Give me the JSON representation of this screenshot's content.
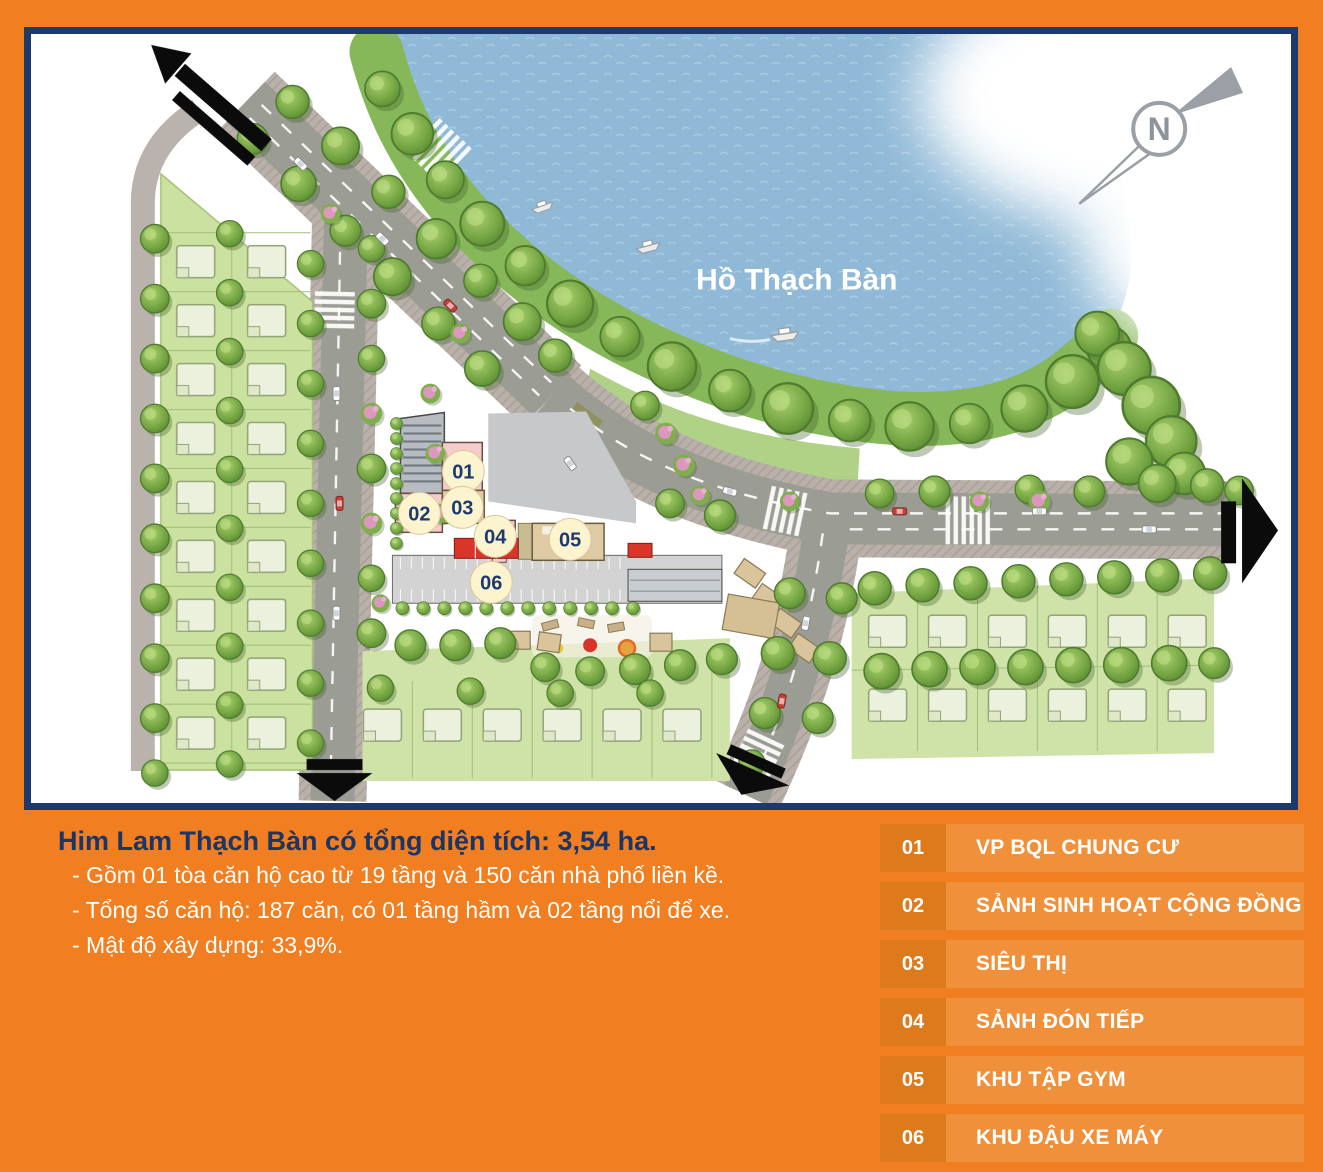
{
  "map": {
    "lake_label": "Hồ Thạch Bàn",
    "compass_label": "N",
    "markers": [
      "01",
      "02",
      "03",
      "04",
      "05",
      "06"
    ]
  },
  "info": {
    "title": "Him Lam Thạch Bàn có tổng diện tích: 3,54 ha.",
    "lines": [
      "- Gồm 01 tòa căn hộ cao từ 19 tầng và 150 căn nhà phố liền kề.",
      "- Tổng số căn hộ: 187 căn, có 01 tầng hầm và 02 tầng nổi để xe.",
      "- Mật độ xây dựng: 33,9%."
    ]
  },
  "legend": {
    "items": [
      {
        "num": "01",
        "label": "VP BQL CHUNG CƯ"
      },
      {
        "num": "02",
        "label": "SẢNH SINH HOẠT CỘNG ĐỒNG"
      },
      {
        "num": "03",
        "label": "SIÊU THỊ"
      },
      {
        "num": "04",
        "label": "SẢNH ĐÓN TIẾP"
      },
      {
        "num": "05",
        "label": "KHU TẬP GYM"
      },
      {
        "num": "06",
        "label": "KHU ĐẬU XE MÁY"
      }
    ]
  },
  "colors": {
    "frame_orange": "#F17E20",
    "frame_navy": "#1C3A6B",
    "water_blue": "#8FB9D7",
    "title_navy": "#1A3566",
    "legend_row_bg": "#F0903A",
    "legend_num_bg": "#DC7A1C",
    "marker_bg": "#FCF3CF",
    "marker_text": "#1D3A6E",
    "grass_green": "#CBE19F",
    "road_gray": "#9B9C94"
  }
}
